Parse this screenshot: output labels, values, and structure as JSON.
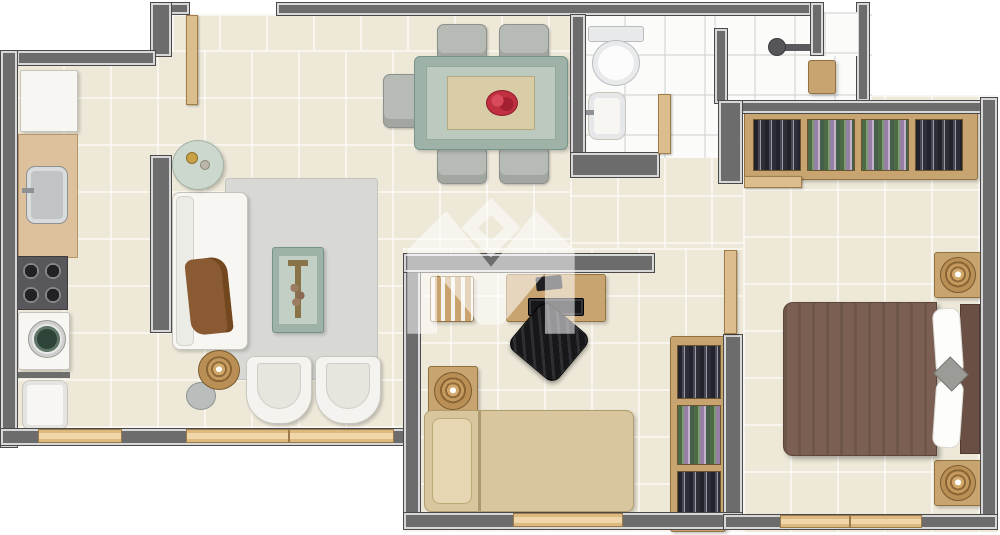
{
  "title": "apartment-floor-plan",
  "watermark": {
    "shape": "m-crown-with-diamond",
    "color": "#ffffff",
    "opacity": 0.55
  },
  "palette": {
    "outside": "#ffffff",
    "floor_tile": "#ede8d8",
    "bath_tile": "#fbfbfa",
    "wall": "#6c6c6c",
    "wall_highlight": "#d7d7d7",
    "window_frame": "#f0d6a8",
    "door": "#dcbd8e",
    "wood": "#c8a470",
    "rug": "#d8d9d5",
    "table_green": "#9fb2a8",
    "flowers_red": "#c03040",
    "master_duvet": "#7b5f52",
    "single_bed": "#d8c69e",
    "office_chair": "#1b1b1e",
    "washer_door_green": "#2f4438"
  },
  "rooms": {
    "kitchen": {
      "label": "Kitchen / Laundry",
      "furniture": [
        "refrigerator",
        "counter-with-sink",
        "stove",
        "washing-machine",
        "laundry-tank"
      ]
    },
    "living": {
      "label": "Living Room",
      "furniture": [
        "sofa",
        "brown-throw",
        "round-side-table",
        "lamp-side-table",
        "plant",
        "rug",
        "coffee-table",
        "armchair-left",
        "armchair-right"
      ]
    },
    "dining": {
      "label": "Dining Room",
      "furniture": [
        "dining-table",
        "table-runner",
        "red-flower-centerpiece",
        "chair-top-left",
        "chair-top-right",
        "chair-bottom-left",
        "chair-bottom-right",
        "chair-left"
      ]
    },
    "bathroom": {
      "label": "Bathroom",
      "furniture": [
        "toilet",
        "washbasin",
        "shower-head",
        "niche"
      ]
    },
    "hallway": {
      "label": "Hallway",
      "furniture": []
    },
    "office": {
      "label": "Second Bedroom / Office",
      "furniture": [
        "bookshelf",
        "desk",
        "laptop",
        "office-chair",
        "nightstand-with-lamp",
        "single-bed",
        "wardrobe"
      ]
    },
    "master": {
      "label": "Master Bedroom",
      "furniture": [
        "closet-wardrobe",
        "double-bed",
        "pillows",
        "headboard",
        "nightstand-with-lamp-top",
        "nightstand-with-lamp-bottom"
      ]
    }
  },
  "openings": {
    "entry_door": "top-entry",
    "bathroom_door": "hall-to-bath",
    "office_door": "hall-to-office",
    "master_door": "hall-to-master",
    "windows": [
      "kitchen-window",
      "living-window",
      "office-window",
      "master-window"
    ]
  }
}
